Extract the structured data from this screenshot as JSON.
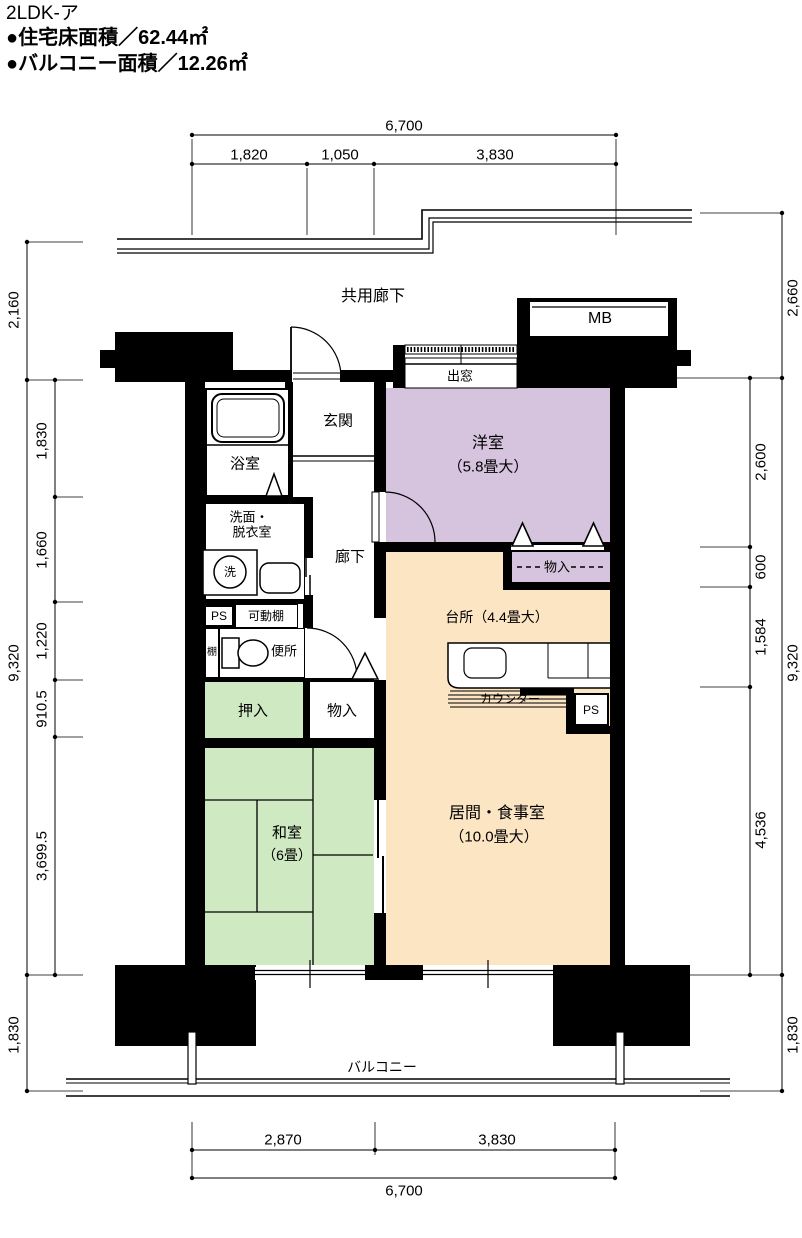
{
  "header": {
    "title": "2LDK-ア",
    "floor_area": "●住宅床面積／62.44㎡",
    "balcony_area": "●バルコニー面積／12.26㎡"
  },
  "labels": {
    "common_corridor": "共用廊下",
    "mb": "MB",
    "bay_window": "出窓",
    "entrance": "玄関",
    "bath": "浴室",
    "washroom_line1": "洗面・",
    "washroom_line2": "脱衣室",
    "washer": "洗",
    "hallway": "廊下",
    "ps": "PS",
    "movable_shelf": "可動棚",
    "shelf": "棚",
    "toilet": "便所",
    "closet_oshiire": "押入",
    "storage_monoire": "物入",
    "western_room": "洋室",
    "western_room_size": "（5.8畳大）",
    "storage_monoire2": "物入",
    "kitchen": "台所（4.4畳大）",
    "counter": "カウンター",
    "ps2": "PS",
    "living_dining": "居間・食事室",
    "living_dining_size": "（10.0畳大）",
    "japanese_room": "和室",
    "japanese_room_size": "（6畳）",
    "balcony": "バルコニー"
  },
  "dims": {
    "top": {
      "total": "6,700",
      "seg1": "1,820",
      "seg2": "1,050",
      "seg3": "3,830"
    },
    "bottom": {
      "seg1": "2,870",
      "seg2": "3,830",
      "total": "6,700"
    },
    "left": {
      "outer1": "2,160",
      "outer2": "9,320",
      "outer3": "1,830",
      "inner1": "1,830",
      "inner2": "1,660",
      "inner3": "1,220",
      "inner4": "910.5",
      "inner5": "3,699.5"
    },
    "right": {
      "outer1": "2,660",
      "outer2": "9,320",
      "outer3": "1,830",
      "inner1": "2,600",
      "inner2": "600",
      "inner3": "1,584",
      "inner4": "4,536"
    }
  },
  "colors": {
    "western_room": "#d6c3de",
    "tatami": "#cfe9c2",
    "ld_kitchen": "#fbe5c3",
    "wall": "#000000"
  }
}
